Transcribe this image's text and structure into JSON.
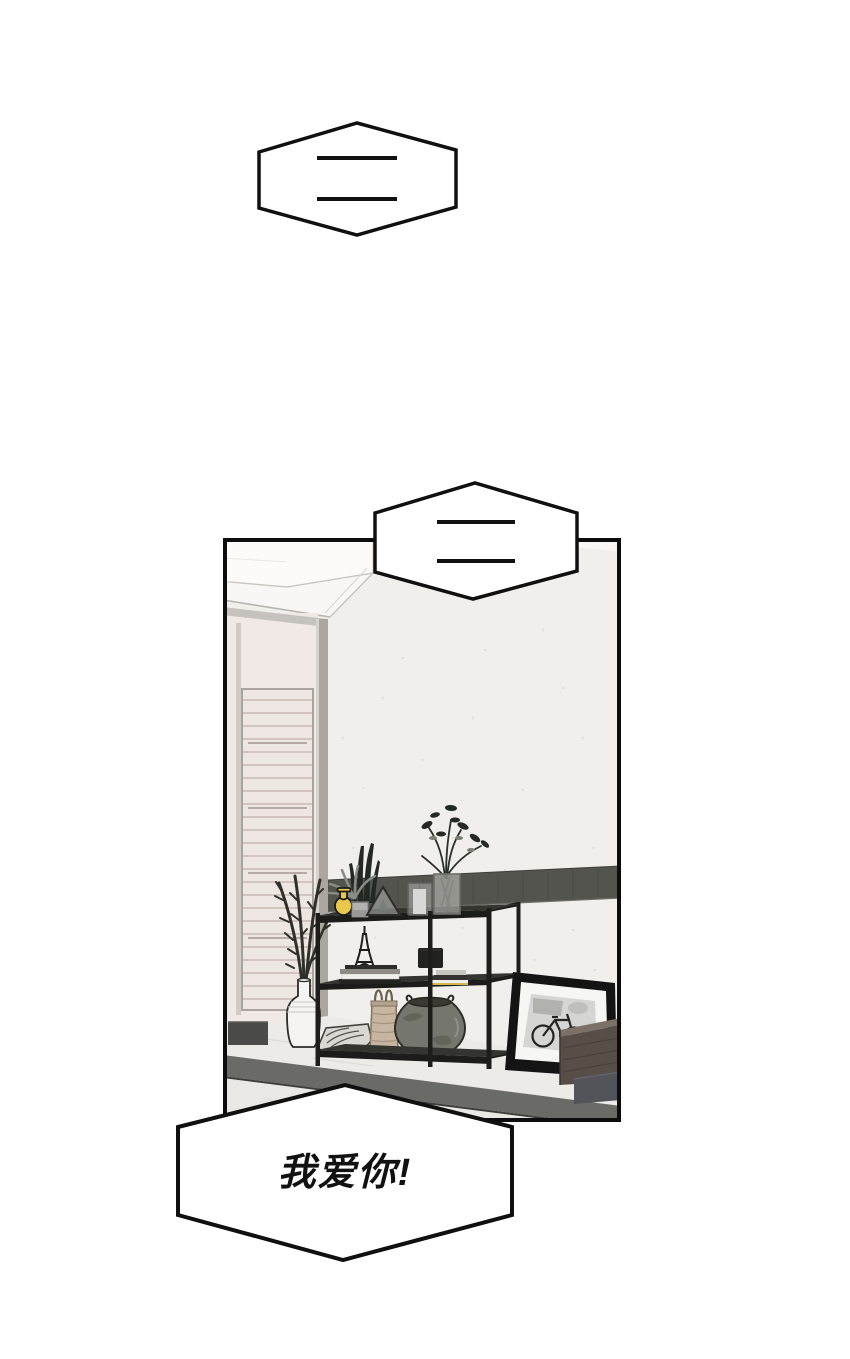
{
  "page": {
    "width": 850,
    "height": 1359,
    "background": "#ffffff"
  },
  "speech_bubbles": [
    {
      "id": "top",
      "shape": "hexagon",
      "content": "silent-dashes",
      "dash_count": 2,
      "text": ""
    },
    {
      "id": "middle",
      "shape": "hexagon",
      "content": "silent-dashes",
      "dash_count": 2,
      "text": ""
    },
    {
      "id": "bottom",
      "shape": "hexagon",
      "content": "text",
      "text": "我爱你!"
    }
  ],
  "panel": {
    "scene": "living-room-interior",
    "objects": [
      "ceiling-bulkhead",
      "door-frame",
      "slatted-door",
      "wall-dado-band",
      "metal-shelving-unit",
      "yellow-vase",
      "potted-plants",
      "glass-prism-terrarium",
      "candle-holder",
      "glass-flower-vase",
      "eiffel-tower-figurine",
      "book-stacks",
      "black-box",
      "white-ceramic-vase",
      "branch-plant",
      "leaf-pillow",
      "woven-basket",
      "ceramic-urn",
      "bicycle-photo-frame",
      "wood-cabinet",
      "marble-platform"
    ]
  },
  "colors": {
    "panel_border": "#0d0d0d",
    "bubble_outline": "#101010",
    "bubble_fill": "#ffffff",
    "text_color": "#111111",
    "wall": "#f1efec",
    "ceiling": "#fbfaf8",
    "dado_band": "#53544d",
    "marble_floor": "#ecebe8",
    "platform_face": "#6a6a67",
    "shelf_metal": "#1d1d1c",
    "yellow_vase": "#e9c84e",
    "basket": "#c6b5a0",
    "urn": "#75776e",
    "cabinet_wood": "#584e48",
    "slat_door": "#eee6e2"
  }
}
